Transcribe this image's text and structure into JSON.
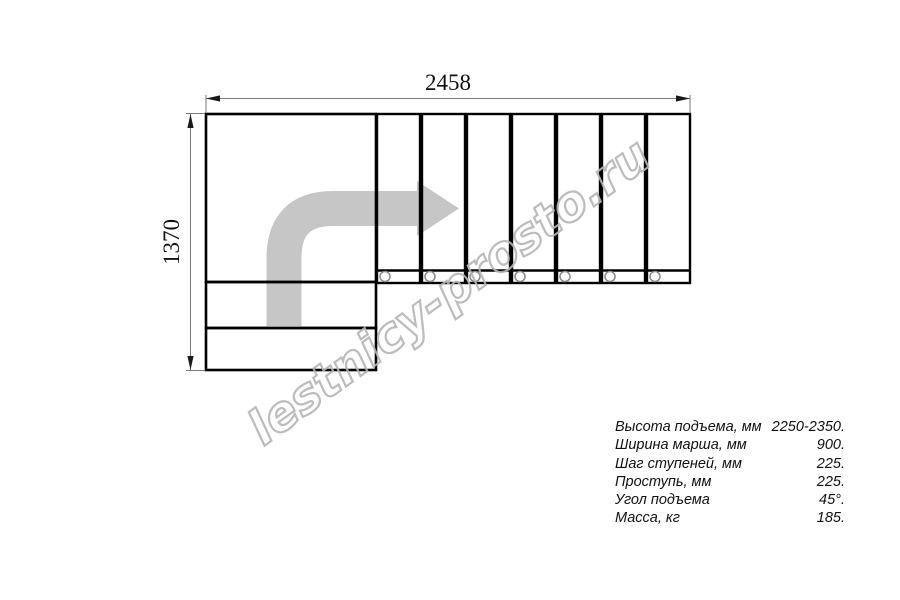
{
  "drawing": {
    "top_dimension": "2458",
    "left_dimension": "1370",
    "tread_count": 7,
    "watermark": "lestnicy-prosto.ru",
    "line_color": "#000000",
    "dimension_line_color": "#7a7a7a",
    "arrow_color": "#c6c6c6",
    "watermark_color": "#b5b5b5"
  },
  "specs": {
    "rows": [
      {
        "label": "Высота подъема, мм",
        "value": "2250-2350."
      },
      {
        "label": "Ширина марша, мм",
        "value": "900."
      },
      {
        "label": "Шаг ступеней, мм",
        "value": "225."
      },
      {
        "label": "Проступь, мм",
        "value": "225."
      },
      {
        "label": "Угол подъема",
        "value": "45°."
      },
      {
        "label": "Масса, кг",
        "value": "185."
      }
    ]
  }
}
